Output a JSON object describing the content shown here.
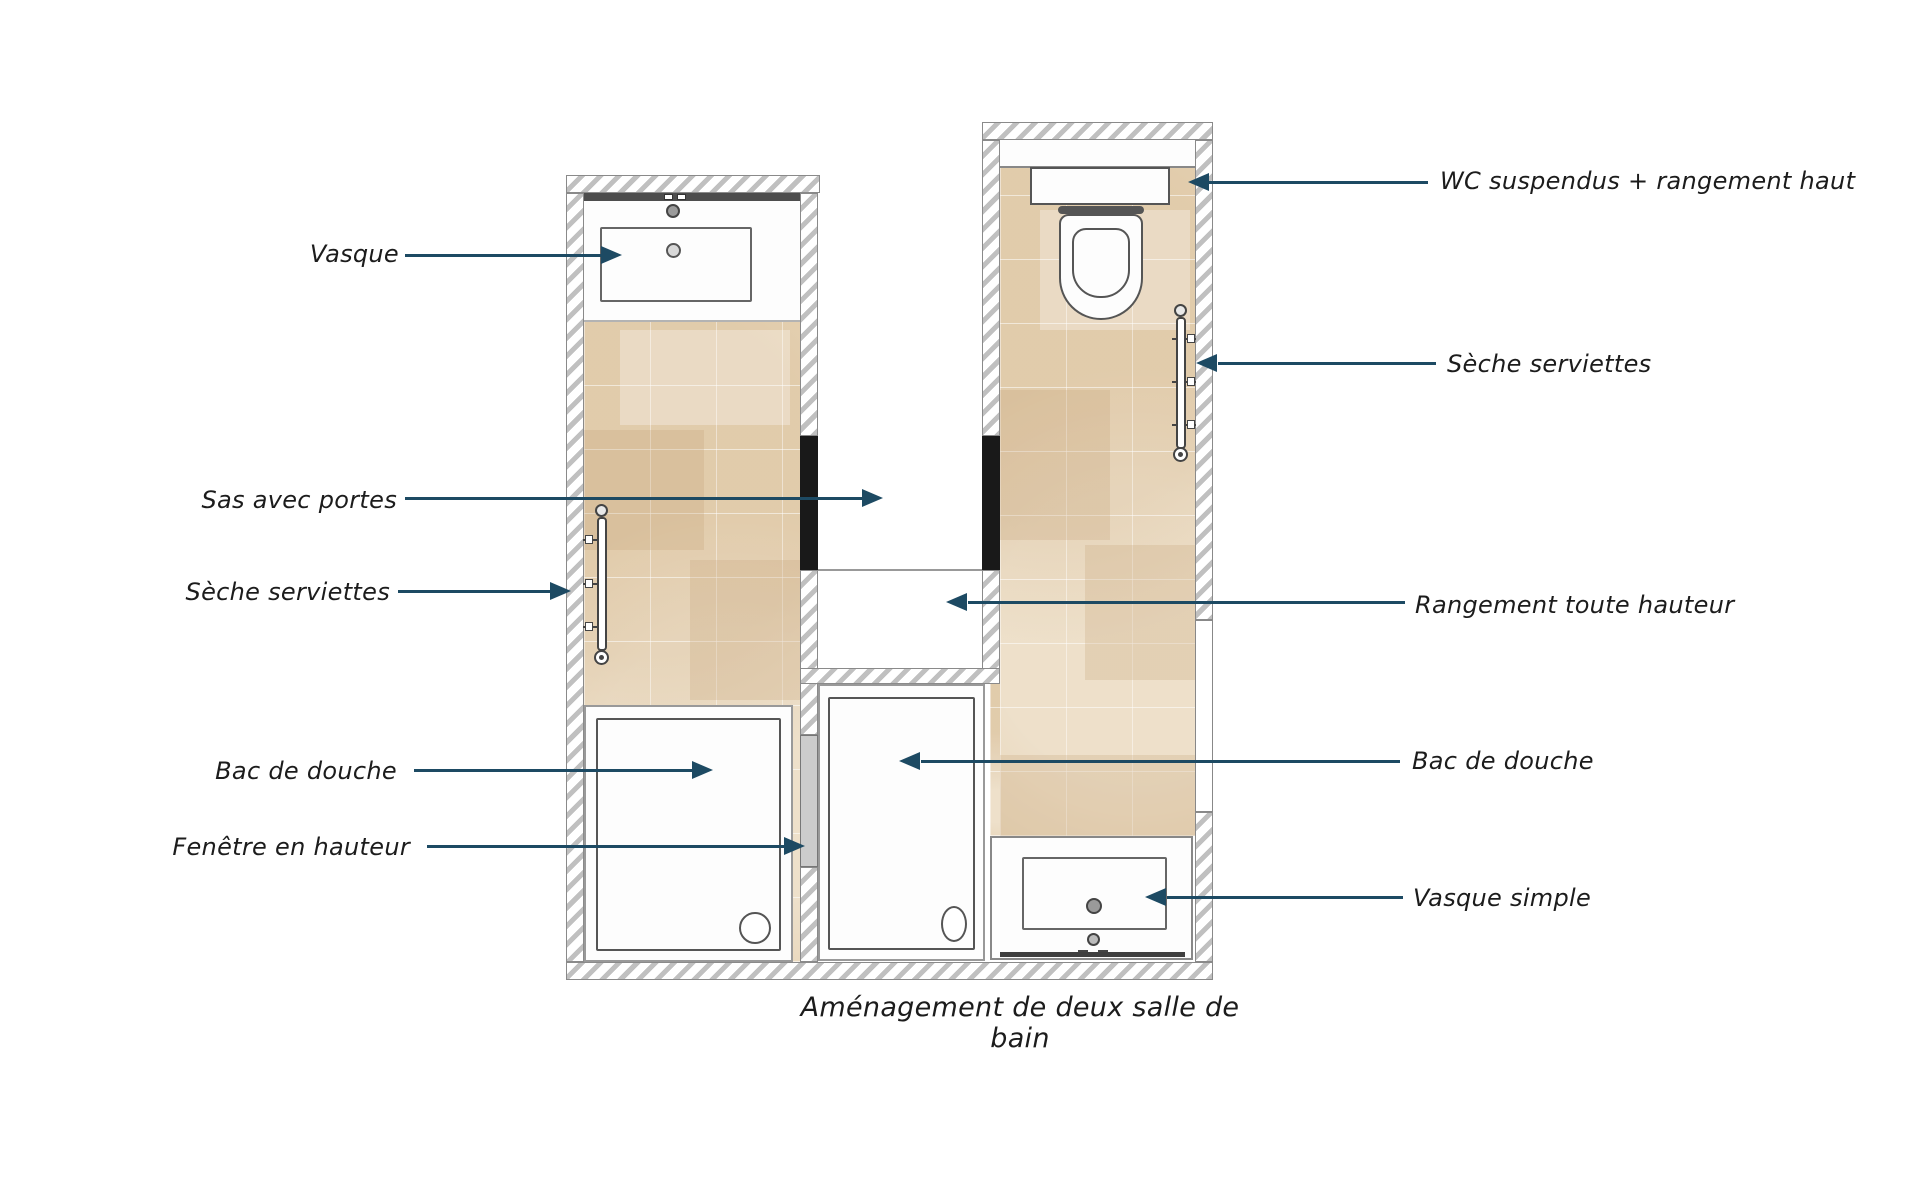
{
  "caption": "Aménagement de deux salle de bain",
  "labels": [
    {
      "id": "vasque",
      "text": "Vasque",
      "side": "left"
    },
    {
      "id": "wc_suspendus",
      "text": "WC suspendus  + rangement haut",
      "side": "right"
    },
    {
      "id": "seche_serviettes_droite",
      "text": "Sèche serviettes",
      "side": "right"
    },
    {
      "id": "sas_avec_portes",
      "text": "Sas avec portes",
      "side": "left"
    },
    {
      "id": "seche_serviettes_gauche",
      "text": "Sèche serviettes",
      "side": "left"
    },
    {
      "id": "rangement_toute_hauteur",
      "text": "Rangement toute hauteur",
      "side": "right"
    },
    {
      "id": "bac_de_douche_gauche",
      "text": "Bac de douche",
      "side": "left"
    },
    {
      "id": "fenetre_en_hauteur",
      "text": "Fenêtre en hauteur",
      "side": "left"
    },
    {
      "id": "bac_de_douche_droite",
      "text": "Bac de douche",
      "side": "right"
    },
    {
      "id": "vasque_simple",
      "text": "Vasque simple",
      "side": "right"
    }
  ],
  "colors": {
    "arrow": "#1d4a63",
    "label_text": "#1c1c1c",
    "tile_base": "#e7d4b6",
    "wall_stripe": "#c0c0c0",
    "wall_outline": "#8a8a8a",
    "door_fill": "#191919",
    "window_fill": "#cccccc",
    "fixture_outline": "#555555"
  }
}
